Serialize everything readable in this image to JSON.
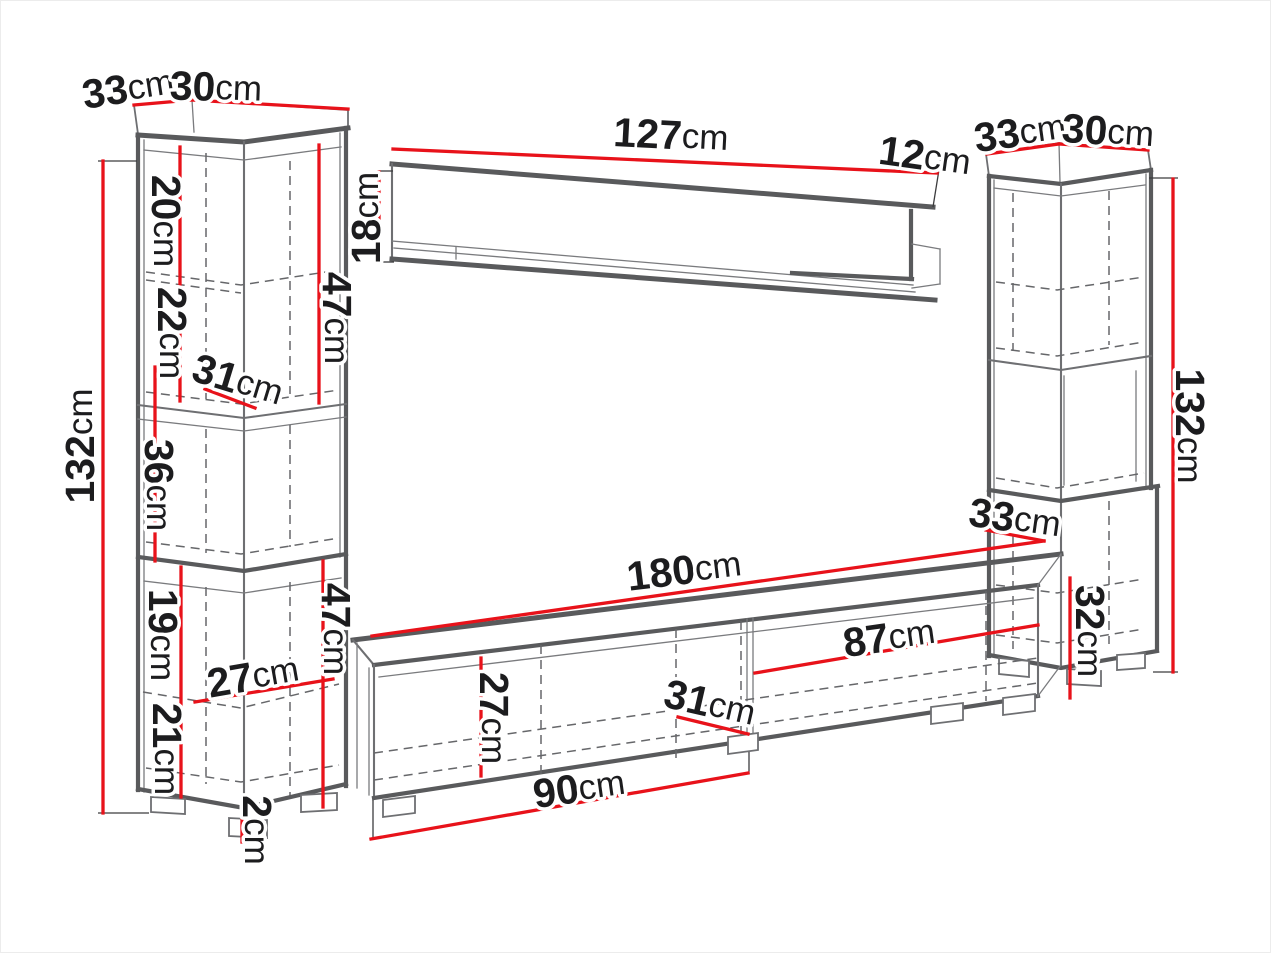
{
  "meta": {
    "description": "Technical dimension diagram of a living-room wall unit: left tall cabinet, wall shelf, right tall cabinet and TV stand",
    "unit": "cm",
    "colors": {
      "dimension_red": "#e8121a",
      "outline_gray": "#595a5c",
      "text": "#1c1c1e",
      "background": "#ffffff"
    }
  },
  "dims": {
    "lcTopDepth": {
      "value": "33",
      "unit": "cm"
    },
    "lcTopWidth": {
      "value": "30",
      "unit": "cm"
    },
    "lcHeight": {
      "value": "132",
      "unit": "cm"
    },
    "lcSection1": {
      "value": "20",
      "unit": "cm"
    },
    "lcSection2": {
      "value": "22",
      "unit": "cm"
    },
    "lcShelfDepth": {
      "value": "31",
      "unit": "cm"
    },
    "lcUpperBox": {
      "value": "47",
      "unit": "cm"
    },
    "lcSection3": {
      "value": "36",
      "unit": "cm"
    },
    "lcSection4": {
      "value": "19",
      "unit": "cm"
    },
    "lcShelfWidth": {
      "value": "27",
      "unit": "cm"
    },
    "lcSection5": {
      "value": "21",
      "unit": "cm"
    },
    "lcLowerBox": {
      "value": "47",
      "unit": "cm"
    },
    "lcFeet": {
      "value": "2",
      "unit": "cm"
    },
    "wsLength": {
      "value": "127",
      "unit": "cm"
    },
    "wsEndDepth": {
      "value": "12",
      "unit": "cm"
    },
    "wsHeight": {
      "value": "18",
      "unit": "cm"
    },
    "rcTopDepth": {
      "value": "33",
      "unit": "cm"
    },
    "rcTopWidth": {
      "value": "30",
      "unit": "cm"
    },
    "rcHeight": {
      "value": "132",
      "unit": "cm"
    },
    "rcLowerBox": {
      "value": "32",
      "unit": "cm"
    },
    "tvLength": {
      "value": "180",
      "unit": "cm"
    },
    "tvTopDepth": {
      "value": "33",
      "unit": "cm"
    },
    "tvRightDoor": {
      "value": "87",
      "unit": "cm"
    },
    "tvInnerHeight": {
      "value": "27",
      "unit": "cm"
    },
    "tvBottomDepth": {
      "value": "31",
      "unit": "cm"
    },
    "tvLeftDoor": {
      "value": "90",
      "unit": "cm"
    }
  }
}
